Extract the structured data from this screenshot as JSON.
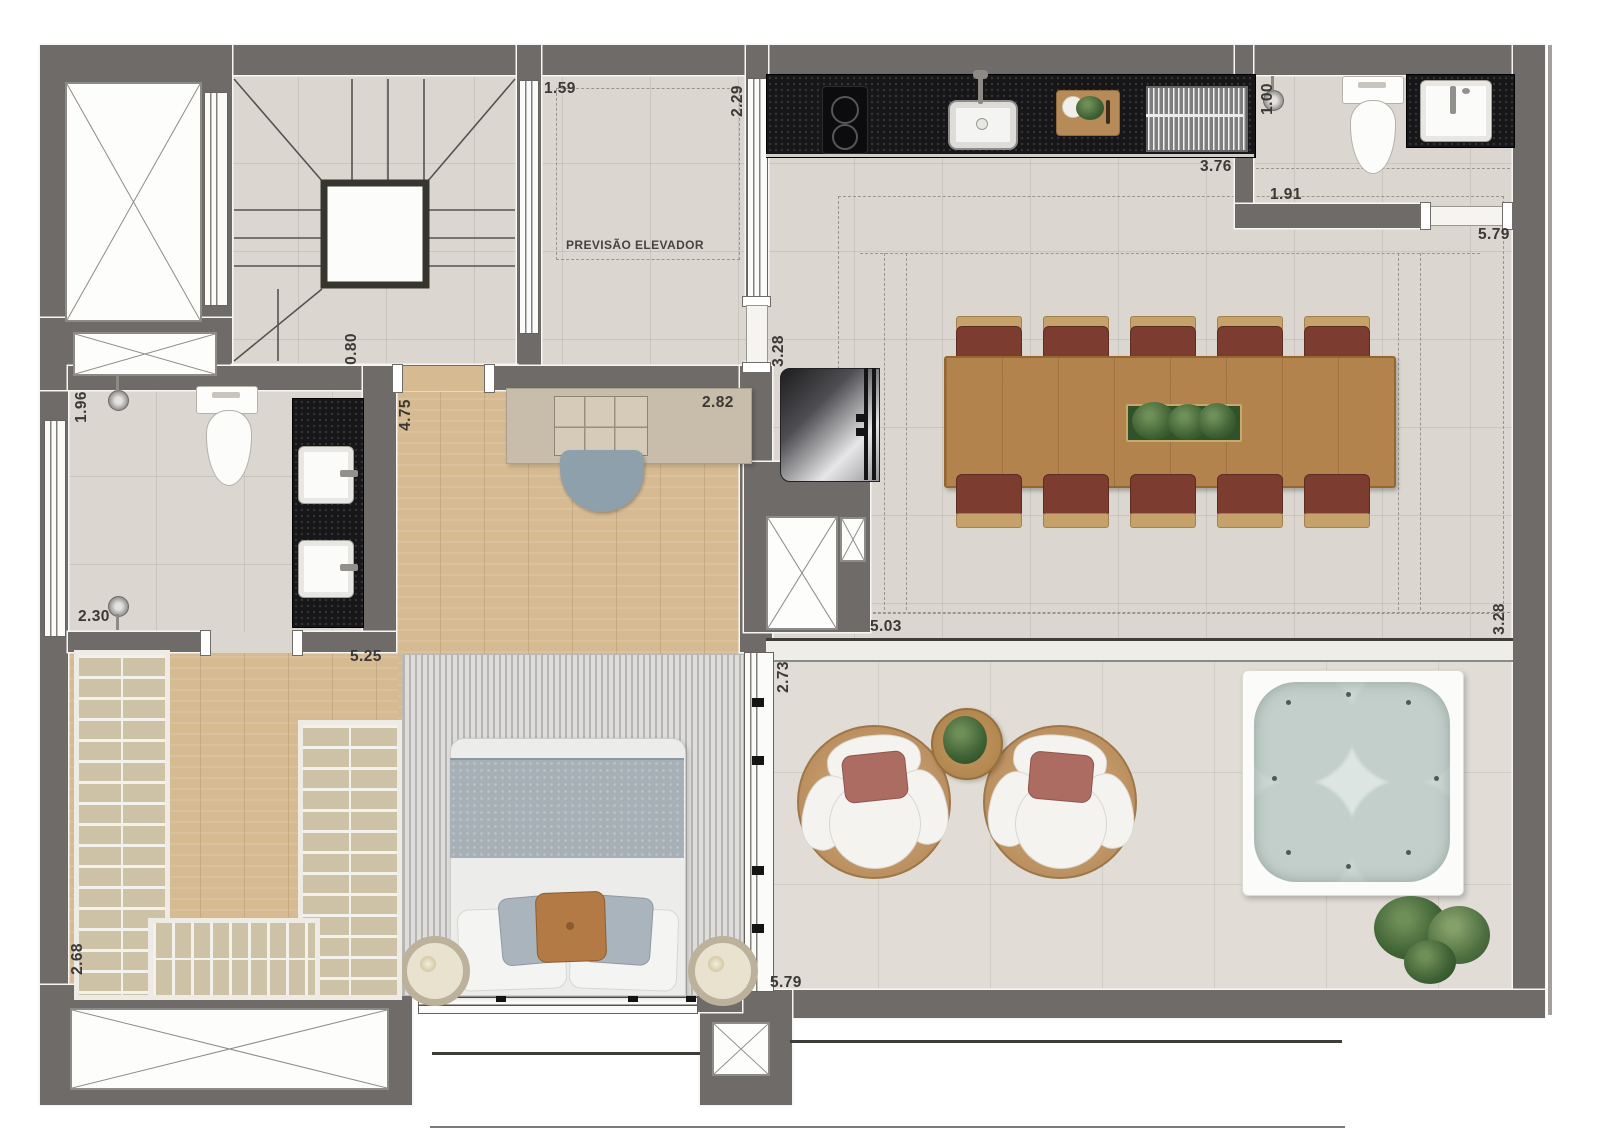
{
  "plan": {
    "elevator_note": "PREVISÃO ELEVADOR",
    "dimensions": {
      "stair_hall_width": "1.59",
      "hall_depth": "2.29",
      "bath_top_shower": "1.00",
      "kitchen_counter": "3.76",
      "bath_top_width": "1.91",
      "living_top_width": "5.79",
      "stair_exit": "0.80",
      "living_left_depth": "3.28",
      "bath_left_width": "1.96",
      "bedroom_depth": "4.75",
      "bedroom_top_width": "2.82",
      "bath_left_length": "2.30",
      "bedroom_width": "5.25",
      "living_bottom_width": "5.03",
      "terrace_left_depth": "2.73",
      "terrace_right_depth": "3.28",
      "closet_depth": "2.68",
      "terrace_bottom_width": "5.79"
    }
  },
  "colors": {
    "wall": "#6e6b68",
    "tile": "#dbd7d0",
    "terrace": "#e1ddd6",
    "wood": "#d6ba92",
    "granite": "#17171a",
    "table": "#b3834e",
    "chairSeat": "#7c3c30",
    "chairBack": "#c6a26b",
    "lounge": "#b98d5e",
    "water": "#ccd7d3",
    "plant": "#3e6134",
    "pillowAccent": "#b47a46",
    "rug": "#c9c9c7",
    "blanket": "#a7b0b6"
  }
}
